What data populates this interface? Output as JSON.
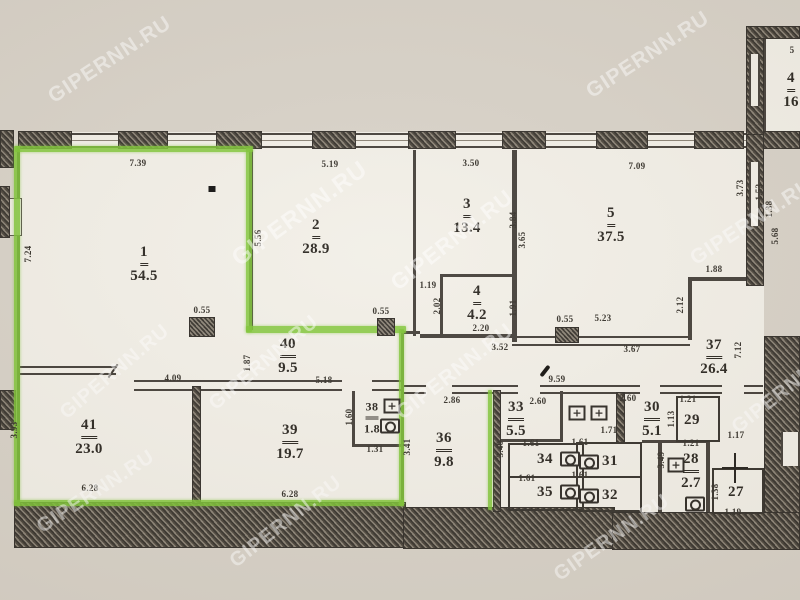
{
  "document": {
    "kind": "apartment floor plan scan"
  },
  "watermark": {
    "text": "GIPERNN.RU",
    "instances": [
      {
        "x": 110,
        "y": 60,
        "size": 21,
        "rot": -33
      },
      {
        "x": 648,
        "y": 55,
        "size": 21,
        "rot": -33
      },
      {
        "x": 300,
        "y": 214,
        "size": 24,
        "rot": -36
      },
      {
        "x": 452,
        "y": 240,
        "size": 22,
        "rot": -38
      },
      {
        "x": 752,
        "y": 222,
        "size": 21,
        "rot": -33
      },
      {
        "x": 115,
        "y": 372,
        "size": 20,
        "rot": -40
      },
      {
        "x": 264,
        "y": 363,
        "size": 20,
        "rot": -40
      },
      {
        "x": 455,
        "y": 372,
        "size": 21,
        "rot": -38
      },
      {
        "x": 96,
        "y": 492,
        "size": 20,
        "rot": -33
      },
      {
        "x": 286,
        "y": 522,
        "size": 20,
        "rot": -38
      },
      {
        "x": 612,
        "y": 538,
        "size": 20,
        "rot": -35
      },
      {
        "x": 788,
        "y": 388,
        "size": 20,
        "rot": -38
      }
    ]
  },
  "colors": {
    "paper": "#d8d2c8",
    "floor": "#f2efe7",
    "wall": "#45403a",
    "highlight_green": "#7fc636",
    "ink": "#2b2721"
  },
  "rooms": [
    {
      "number": "1",
      "area": "54.5",
      "x": 144,
      "y": 264
    },
    {
      "number": "2",
      "area": "28.9",
      "x": 316,
      "y": 237
    },
    {
      "number": "3",
      "area": "13.4",
      "x": 467,
      "y": 216
    },
    {
      "number": "4",
      "area": "4.2",
      "x": 477,
      "y": 303
    },
    {
      "number": "5",
      "area": "37.5",
      "x": 611,
      "y": 225
    },
    {
      "number": "37",
      "area": "26.4",
      "x": 714,
      "y": 357
    },
    {
      "number": "40",
      "area": "9.5",
      "x": 288,
      "y": 356
    },
    {
      "number": "41",
      "area": "23.0",
      "x": 89,
      "y": 437
    },
    {
      "number": "39",
      "area": "19.7",
      "x": 290,
      "y": 442
    },
    {
      "number": "38",
      "area": "1.8",
      "x": 372,
      "y": 417,
      "small": true
    },
    {
      "number": "36",
      "area": "9.8",
      "x": 444,
      "y": 450
    },
    {
      "number": "33",
      "area": "5.5",
      "x": 516,
      "y": 419
    },
    {
      "number": "34",
      "area": "",
      "x": 545,
      "y": 459
    },
    {
      "number": "35",
      "area": "",
      "x": 545,
      "y": 492
    },
    {
      "number": "30",
      "area": "5.1",
      "x": 652,
      "y": 419
    },
    {
      "number": "29",
      "area": "",
      "x": 692,
      "y": 420
    },
    {
      "number": "31",
      "area": "",
      "x": 610,
      "y": 461
    },
    {
      "number": "32",
      "area": "",
      "x": 610,
      "y": 495
    },
    {
      "number": "28",
      "area": "2.7",
      "x": 691,
      "y": 471
    },
    {
      "number": "27",
      "area": "",
      "x": 736,
      "y": 492
    },
    {
      "number": "4",
      "area": "16",
      "x": 791,
      "y": 90
    }
  ],
  "dimensions": [
    {
      "text": "7.39",
      "x": 138,
      "y": 163,
      "v": false
    },
    {
      "text": "5.19",
      "x": 330,
      "y": 164,
      "v": false
    },
    {
      "text": "3.50",
      "x": 471,
      "y": 163,
      "v": false
    },
    {
      "text": "7.09",
      "x": 637,
      "y": 166,
      "v": false
    },
    {
      "text": "5",
      "x": 792,
      "y": 50,
      "v": false
    },
    {
      "text": "7.24",
      "x": 28,
      "y": 254,
      "v": true
    },
    {
      "text": "5.56",
      "x": 258,
      "y": 238,
      "v": true
    },
    {
      "text": "3.84",
      "x": 513,
      "y": 220,
      "v": true
    },
    {
      "text": "3.65",
      "x": 522,
      "y": 240,
      "v": true
    },
    {
      "text": "3.73",
      "x": 740,
      "y": 188,
      "v": true
    },
    {
      "text": "1.53",
      "x": 759,
      "y": 192,
      "v": true
    },
    {
      "text": "1.38",
      "x": 769,
      "y": 209,
      "v": true
    },
    {
      "text": "5.68",
      "x": 775,
      "y": 236,
      "v": true
    },
    {
      "text": "1.19",
      "x": 428,
      "y": 285,
      "v": false
    },
    {
      "text": "2.02",
      "x": 437,
      "y": 306,
      "v": true
    },
    {
      "text": "1.91",
      "x": 513,
      "y": 308,
      "v": true
    },
    {
      "text": "2.20",
      "x": 481,
      "y": 328,
      "v": false
    },
    {
      "text": "1.88",
      "x": 714,
      "y": 269,
      "v": false
    },
    {
      "text": "2.12",
      "x": 680,
      "y": 305,
      "v": true
    },
    {
      "text": "0.55",
      "x": 565,
      "y": 319,
      "v": false
    },
    {
      "text": "5.23",
      "x": 603,
      "y": 318,
      "v": false
    },
    {
      "text": "3.52",
      "x": 500,
      "y": 347,
      "v": false
    },
    {
      "text": "3.67",
      "x": 632,
      "y": 349,
      "v": false
    },
    {
      "text": "7.12",
      "x": 738,
      "y": 350,
      "v": true
    },
    {
      "text": "0.55",
      "x": 381,
      "y": 311,
      "v": false
    },
    {
      "text": "0.55",
      "x": 202,
      "y": 310,
      "v": false
    },
    {
      "text": "1.87",
      "x": 247,
      "y": 363,
      "v": true
    },
    {
      "text": "5.18",
      "x": 324,
      "y": 380,
      "v": false
    },
    {
      "text": "4.09",
      "x": 173,
      "y": 378,
      "v": false
    },
    {
      "text": "9.59",
      "x": 557,
      "y": 379,
      "v": false
    },
    {
      "text": "3.93",
      "x": 14,
      "y": 430,
      "v": true
    },
    {
      "text": "6.28",
      "x": 90,
      "y": 488,
      "v": false
    },
    {
      "text": "6.28",
      "x": 290,
      "y": 494,
      "v": false
    },
    {
      "text": "1.60",
      "x": 349,
      "y": 417,
      "v": true
    },
    {
      "text": "1.31",
      "x": 375,
      "y": 449,
      "v": false
    },
    {
      "text": "3.41",
      "x": 407,
      "y": 447,
      "v": true
    },
    {
      "text": "2.86",
      "x": 452,
      "y": 400,
      "v": false
    },
    {
      "text": "2.60",
      "x": 538,
      "y": 401,
      "v": false
    },
    {
      "text": "2.60",
      "x": 628,
      "y": 398,
      "v": false
    },
    {
      "text": "1.21",
      "x": 688,
      "y": 399,
      "v": false
    },
    {
      "text": "3.40",
      "x": 500,
      "y": 449,
      "v": true
    },
    {
      "text": "1.61",
      "x": 531,
      "y": 443,
      "v": false
    },
    {
      "text": "1.61",
      "x": 527,
      "y": 478,
      "v": false
    },
    {
      "text": "1.71",
      "x": 609,
      "y": 430,
      "v": false
    },
    {
      "text": "1.61",
      "x": 580,
      "y": 442,
      "v": false
    },
    {
      "text": "1.61",
      "x": 580,
      "y": 475,
      "v": false
    },
    {
      "text": "1.13",
      "x": 671,
      "y": 419,
      "v": true
    },
    {
      "text": "1.21",
      "x": 691,
      "y": 443,
      "v": false
    },
    {
      "text": "1.17",
      "x": 736,
      "y": 435,
      "v": false
    },
    {
      "text": "3.49",
      "x": 661,
      "y": 460,
      "v": true
    },
    {
      "text": "1.38",
      "x": 715,
      "y": 492,
      "v": true
    },
    {
      "text": "1.19",
      "x": 733,
      "y": 512,
      "v": false
    }
  ],
  "fixtures": [
    {
      "type": "marker-dot",
      "x": 212,
      "y": 189
    },
    {
      "type": "column",
      "x": 202,
      "y": 327,
      "w": 26,
      "h": 20
    },
    {
      "type": "column",
      "x": 386,
      "y": 327,
      "w": 18,
      "h": 18
    },
    {
      "type": "column",
      "x": 567,
      "y": 335,
      "w": 24,
      "h": 16
    },
    {
      "type": "pen-mark",
      "x": 545,
      "y": 371
    },
    {
      "type": "door-tick",
      "x": 113,
      "y": 371
    },
    {
      "type": "sink",
      "x": 392,
      "y": 406
    },
    {
      "type": "sink",
      "x": 577,
      "y": 413
    },
    {
      "type": "sink",
      "x": 599,
      "y": 413
    },
    {
      "type": "sink",
      "x": 676,
      "y": 465
    },
    {
      "type": "toilet",
      "x": 390,
      "y": 426
    },
    {
      "type": "toilet",
      "x": 570,
      "y": 459
    },
    {
      "type": "toilet",
      "x": 570,
      "y": 492
    },
    {
      "type": "toilet",
      "x": 589,
      "y": 462
    },
    {
      "type": "toilet",
      "x": 589,
      "y": 496
    },
    {
      "type": "toilet",
      "x": 695,
      "y": 504
    },
    {
      "type": "cross",
      "x": 735,
      "y": 468
    }
  ]
}
